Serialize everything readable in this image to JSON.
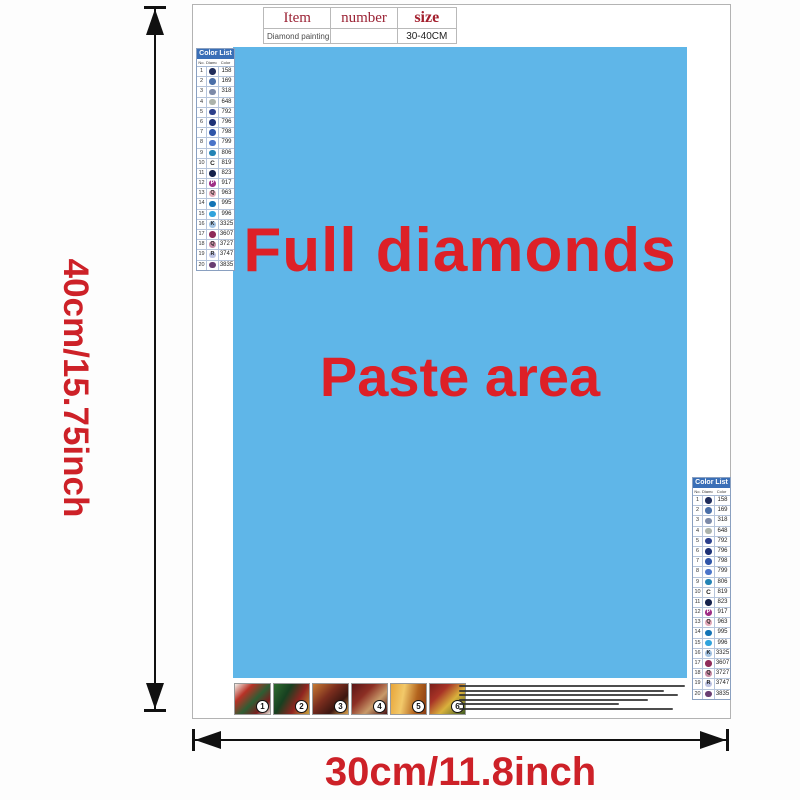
{
  "item_table": {
    "col_item": "Item",
    "col_number": "number",
    "col_size": "size",
    "row_item": "Diamond painting",
    "row_number": "",
    "row_size": "30-40CM"
  },
  "paste_area": {
    "line1": "Full diamonds",
    "line2": "Paste area"
  },
  "dimension_labels": {
    "height": "40cm/15.75inch",
    "width": "30cm/11.8inch"
  },
  "colors": {
    "paste_area_bg": "#5FB6E8",
    "label_red": "#CD2128",
    "paste_text_red": "#DD2027",
    "table_header_red": "#9B2335",
    "color_list_header_bg": "#3A6FB7"
  },
  "color_list": {
    "title": "Color List",
    "col_no": "No.",
    "col_symbol": "Diamond",
    "col_color": "Color",
    "rows": [
      {
        "no": "1",
        "code": "158",
        "dot": "#1F2D5C",
        "letter": ""
      },
      {
        "no": "2",
        "code": "169",
        "dot": "#4A6FA8",
        "letter": ""
      },
      {
        "no": "3",
        "code": "318",
        "dot": "#7C8AA8",
        "letter": ""
      },
      {
        "no": "4",
        "code": "648",
        "dot": "#ACB3AB",
        "letter": ""
      },
      {
        "no": "5",
        "code": "792",
        "dot": "#2B3F8C",
        "letter": ""
      },
      {
        "no": "6",
        "code": "796",
        "dot": "#1D3176",
        "letter": ""
      },
      {
        "no": "7",
        "code": "798",
        "dot": "#2F55A8",
        "letter": ""
      },
      {
        "no": "8",
        "code": "799",
        "dot": "#4A74C9",
        "letter": ""
      },
      {
        "no": "9",
        "code": "806",
        "dot": "#2383B5",
        "letter": ""
      },
      {
        "no": "10",
        "code": "819",
        "dot": "",
        "letter": "C"
      },
      {
        "no": "11",
        "code": "823",
        "dot": "#15214B",
        "letter": ""
      },
      {
        "no": "12",
        "code": "917",
        "dot": "#9E2E86",
        "letter": "P"
      },
      {
        "no": "13",
        "code": "963",
        "dot": "#E3A9B9",
        "letter": "Q"
      },
      {
        "no": "14",
        "code": "995",
        "dot": "#1273B5",
        "letter": ""
      },
      {
        "no": "15",
        "code": "996",
        "dot": "#30A3DC",
        "letter": ""
      },
      {
        "no": "16",
        "code": "3325",
        "dot": "#A3C3E3",
        "letter": "K"
      },
      {
        "no": "17",
        "code": "3607",
        "dot": "#8F2B59",
        "letter": ""
      },
      {
        "no": "18",
        "code": "3727",
        "dot": "#C88CA6",
        "letter": "Q"
      },
      {
        "no": "19",
        "code": "3747",
        "dot": "#BCC2E2",
        "letter": "R"
      },
      {
        "no": "20",
        "code": "3835",
        "dot": "#6A3E72",
        "letter": ""
      }
    ]
  },
  "steps": {
    "items": [
      {
        "num": "1"
      },
      {
        "num": "2"
      },
      {
        "num": "3"
      },
      {
        "num": "4"
      },
      {
        "num": "5"
      },
      {
        "num": "6"
      }
    ]
  }
}
